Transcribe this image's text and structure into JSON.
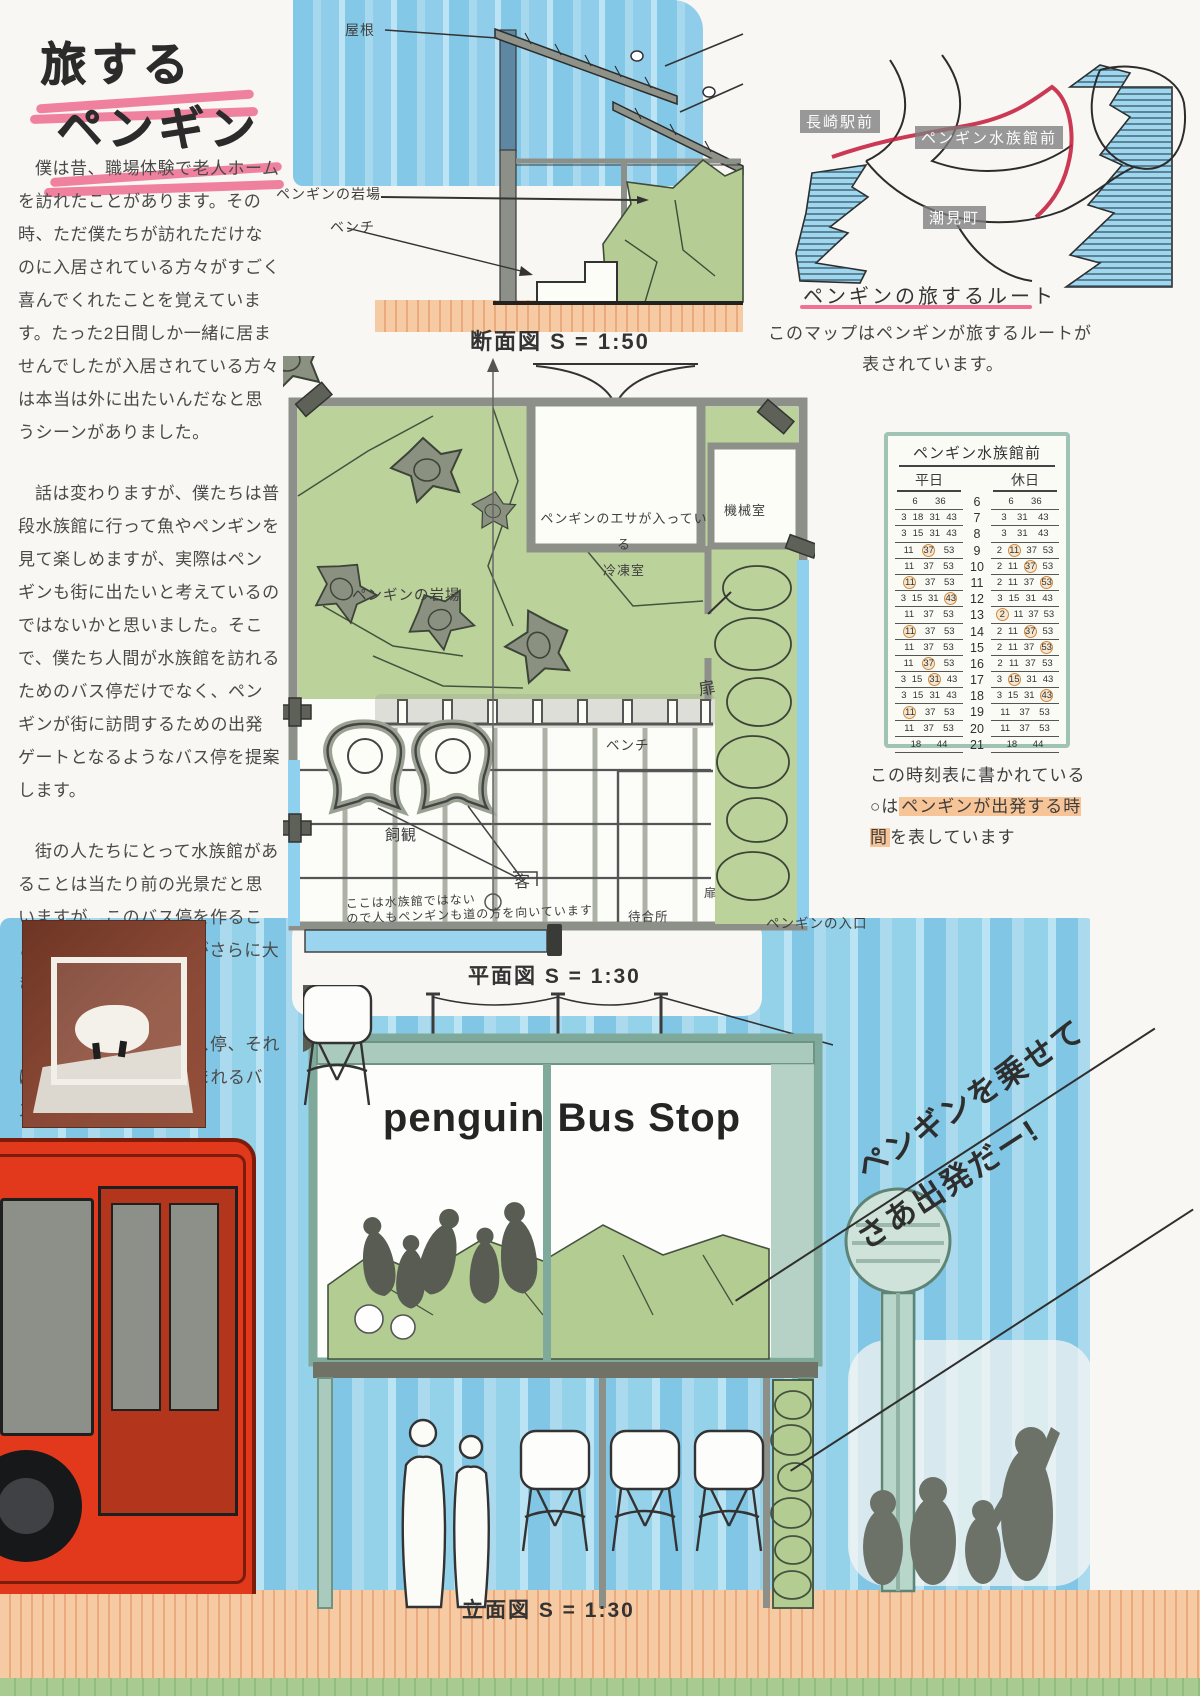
{
  "title": {
    "line1": "旅する",
    "line2": "ペンギン"
  },
  "intro": {
    "p1": "僕は昔、職場体験で老人ホームを訪れたことがあります。その時、ただ僕たちが訪れただけなのに入居されている方々がすごく喜んでくれたことを覚えています。たった2日間しか一緒に居ませんでしたが入居されている方々は本当は外に出たいんだなと思うシーンがありました。",
    "p2": "話は変わりますが、僕たちは普段水族館に行って魚やペンギンを見て楽しめますが、実際はペンギンも街に出たいと考えているのではないかと思いました。そこで、僕たち人間が水族館を訪れるためのバス停だけでなく、ペンギンが街に訪問するための出発ゲートとなるようなバス停を提案します。",
    "p3": "街の人たちにとって水族館があることは当たり前の光景だと思いますが、このバス停を作ることで、街と水族館の輪がさらに大きくなります。",
    "p4": "旅するペンギンのバス停、それは、地域の一体感が生まれるバス停です。"
  },
  "section": {
    "caption": "断面図 S = 1:50",
    "roof": "屋根",
    "rock": "ペンギンの岩場",
    "bench": "ベンチ"
  },
  "route_map": {
    "station": "長崎駅前",
    "aquarium": "ペンギン水族館前",
    "town": "潮見町",
    "title": "ペンギンの旅するルート",
    "desc1": "このマップはペンギンが旅するルートが",
    "desc2": "表されています。"
  },
  "plan": {
    "caption": "平面図 S = 1:30",
    "freezer1": "ペンギンのエサが入っている",
    "freezer2": "冷凍室",
    "machine": "機械室",
    "rock": "ペンギンの岩場",
    "door": "扉",
    "door_small": "扉",
    "bench": "ベンチ",
    "keeper": "飼観",
    "guest": "客",
    "waiting": "待合所",
    "entrance": "ペンギンの入口",
    "note1": "ここは水族館ではない",
    "note2": "ので人もペンギンも道の方を向いています"
  },
  "timetable": {
    "title": "ペンギン水族館前",
    "weekday": "平日",
    "holiday": "休日",
    "rows": [
      {
        "hour": "6",
        "weekday": "6 36",
        "holiday": "6 36"
      },
      {
        "hour": "7",
        "weekday": "3 18 31 43",
        "holiday": "3 31 43"
      },
      {
        "hour": "8",
        "weekday": "3 15 31 43",
        "holiday": "3 31 43"
      },
      {
        "hour": "9",
        "weekday": "11 (37) 53",
        "holiday": "2 (11) 37 53"
      },
      {
        "hour": "10",
        "weekday": "11 37 53",
        "holiday": "2 11 (37) 53"
      },
      {
        "hour": "11",
        "weekday": "(11) 37 53",
        "holiday": "2 11 37 (53)"
      },
      {
        "hour": "12",
        "weekday": "3 15 31 (43)",
        "holiday": "3 15 31 43"
      },
      {
        "hour": "13",
        "weekday": "11 37 53",
        "holiday": "(2) 11 37 53"
      },
      {
        "hour": "14",
        "weekday": "(11) 37 53",
        "holiday": "2 11 (37) 53"
      },
      {
        "hour": "15",
        "weekday": "11 37 53",
        "holiday": "2 11 37 (53)"
      },
      {
        "hour": "16",
        "weekday": "11 (37) 53",
        "holiday": "2 11 37 53"
      },
      {
        "hour": "17",
        "weekday": "3 15 (31) 43",
        "holiday": "3 (15) 31 43"
      },
      {
        "hour": "18",
        "weekday": "3 15 31 43",
        "holiday": "3 15 31 (43)"
      },
      {
        "hour": "19",
        "weekday": "(11) 37 53",
        "holiday": "11 37 53"
      },
      {
        "hour": "20",
        "weekday": "11 37 53",
        "holiday": "11 37 53"
      },
      {
        "hour": "21",
        "weekday": "18 44",
        "holiday": "18 44"
      }
    ],
    "note_pre": "この時刻表に書かれている○は",
    "note_highlight": "ペンギンが出発する時間",
    "note_post": "を表しています"
  },
  "elevation": {
    "sign": "penguin Bus Stop",
    "caption": "立面図 S = 1:30"
  },
  "banner": {
    "line1": "ペンギンを乗せて",
    "line2": "さあ出発だー!"
  },
  "colors": {
    "pink": "#ee6388",
    "sky_blue": "#84c8e8",
    "mint": "#a9cabc",
    "rock_green": "#b5cd94",
    "bus_red": "#e2391d",
    "peach": "#f5c9a0",
    "circle_orange": "#d08b3e"
  }
}
